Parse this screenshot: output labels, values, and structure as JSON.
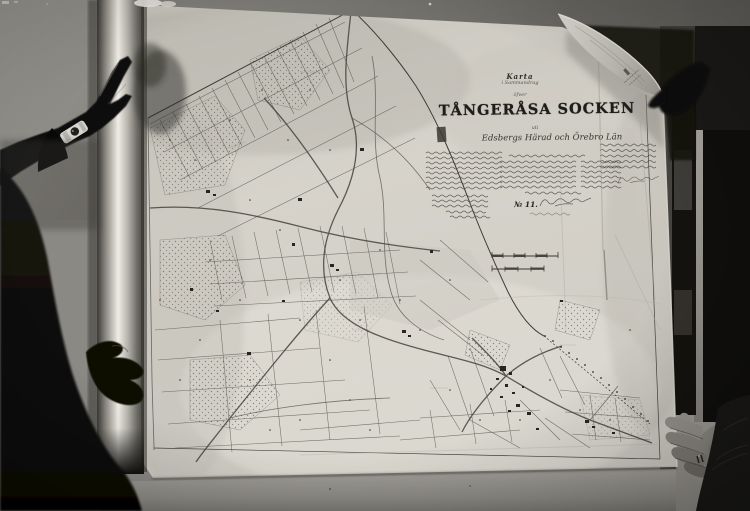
{
  "map_header": {
    "karta": "Karta",
    "sammandrag": "i Sammandrag",
    "ofver": "öfver",
    "title": "TÅNGERÅSA SOCKEN",
    "uti": "uti",
    "subtitle": "Edsbergs Härad och Örebro Län",
    "number": "№ 11."
  },
  "colors": {
    "paper": "#d3d0c8",
    "wall": "#8b8984",
    "ink": "#46443e",
    "shadow": "#0b0b0a"
  }
}
